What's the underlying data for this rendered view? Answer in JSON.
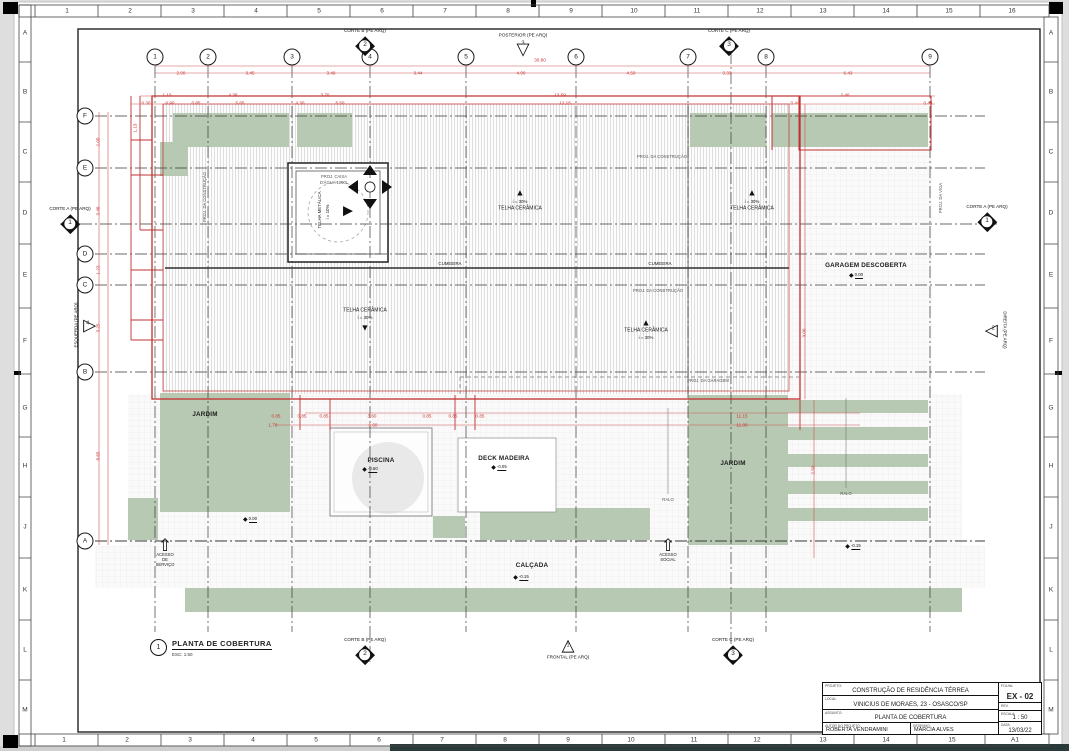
{
  "frame": {
    "top_cells": [
      {
        "t": "1",
        "x": 67
      },
      {
        "t": "2",
        "x": 130
      },
      {
        "t": "3",
        "x": 193
      },
      {
        "t": "4",
        "x": 256
      },
      {
        "t": "5",
        "x": 319
      },
      {
        "t": "6",
        "x": 382
      },
      {
        "t": "7",
        "x": 445
      },
      {
        "t": "8",
        "x": 508
      },
      {
        "t": "9",
        "x": 571
      },
      {
        "t": "10",
        "x": 634
      },
      {
        "t": "11",
        "x": 697
      },
      {
        "t": "12",
        "x": 760
      },
      {
        "t": "13",
        "x": 823
      },
      {
        "t": "14",
        "x": 886
      },
      {
        "t": "15",
        "x": 949
      },
      {
        "t": "16",
        "x": 1012
      }
    ],
    "bottom_cells": [
      {
        "t": "1",
        "x": 64
      },
      {
        "t": "2",
        "x": 127
      },
      {
        "t": "3",
        "x": 190
      },
      {
        "t": "4",
        "x": 253
      },
      {
        "t": "5",
        "x": 316
      },
      {
        "t": "6",
        "x": 379
      },
      {
        "t": "7",
        "x": 442
      },
      {
        "t": "8",
        "x": 505
      },
      {
        "t": "9",
        "x": 568
      },
      {
        "t": "10",
        "x": 631
      },
      {
        "t": "11",
        "x": 694
      },
      {
        "t": "12",
        "x": 757
      },
      {
        "t": "13",
        "x": 823
      },
      {
        "t": "14",
        "x": 886
      },
      {
        "t": "15",
        "x": 952
      },
      {
        "t": "A1",
        "x": 1015
      }
    ],
    "left_cells": [
      {
        "t": "A",
        "y": 33
      },
      {
        "t": "B",
        "y": 92
      },
      {
        "t": "C",
        "y": 152
      },
      {
        "t": "D",
        "y": 213
      },
      {
        "t": "E",
        "y": 275
      },
      {
        "t": "F",
        "y": 341
      },
      {
        "t": "G",
        "y": 408
      },
      {
        "t": "H",
        "y": 466
      },
      {
        "t": "J",
        "y": 527
      },
      {
        "t": "K",
        "y": 590
      },
      {
        "t": "L",
        "y": 650
      },
      {
        "t": "M",
        "y": 710
      }
    ],
    "right_cells": [
      {
        "t": "A",
        "y": 33
      },
      {
        "t": "B",
        "y": 92
      },
      {
        "t": "C",
        "y": 152
      },
      {
        "t": "D",
        "y": 213
      },
      {
        "t": "E",
        "y": 275
      },
      {
        "t": "F",
        "y": 341
      },
      {
        "t": "G",
        "y": 408
      },
      {
        "t": "H",
        "y": 466
      },
      {
        "t": "J",
        "y": 527
      },
      {
        "t": "K",
        "y": 590
      },
      {
        "t": "L",
        "y": 650
      },
      {
        "t": "M",
        "y": 710
      }
    ]
  },
  "axes": {
    "cols": [
      {
        "n": "1",
        "x": 155
      },
      {
        "n": "2",
        "x": 208
      },
      {
        "n": "3",
        "x": 292
      },
      {
        "n": "4",
        "x": 370
      },
      {
        "n": "5",
        "x": 466
      },
      {
        "n": "6",
        "x": 576
      },
      {
        "n": "7",
        "x": 688
      },
      {
        "n": "8",
        "x": 766
      },
      {
        "n": "9",
        "x": 930
      }
    ],
    "rows": [
      {
        "n": "F",
        "y": 116
      },
      {
        "n": "E",
        "y": 168
      },
      {
        "n": "D",
        "y": 254
      },
      {
        "n": "C",
        "y": 285
      },
      {
        "n": "B",
        "y": 372
      },
      {
        "n": "A",
        "y": 541
      }
    ]
  },
  "markers": [
    {
      "label": "CORTE B (PE ARQ)",
      "num": "2",
      "x": 365,
      "y": 43,
      "cls": "diamond"
    },
    {
      "label": "POSTERIOR (PE ARQ)",
      "num": "3",
      "x": 523,
      "y": 46,
      "cls": "tri-down"
    },
    {
      "label": "CORTE C (PE ARQ)",
      "num": "3",
      "x": 729,
      "y": 43,
      "cls": "diamond"
    },
    {
      "label": "CORTE A (PE ARQ)",
      "num": "1",
      "x": 70,
      "y": 221,
      "cls": "diamond"
    },
    {
      "label": "ESQUERDA (PE ARQ)",
      "num": "4",
      "x": 87,
      "y": 325,
      "cls": "tri-right lvert"
    },
    {
      "label": "CORTE A (PE ARQ)",
      "num": "1",
      "x": 987,
      "y": 219,
      "cls": "diamond"
    },
    {
      "label": "DIREITA (PE ARQ)",
      "num": "2",
      "x": 994,
      "y": 330,
      "cls": "tri-left lvert-r"
    },
    {
      "label": "CORTE B (PE ARQ)",
      "num": "2",
      "x": 365,
      "y": 652,
      "cls": "diamond"
    },
    {
      "label": "FRONTAL (PE ARQ)",
      "num": "1",
      "x": 568,
      "y": 648,
      "cls": "tri-up lbottom"
    },
    {
      "label": "CORTE C (PE ARQ)",
      "num": "3",
      "x": 733,
      "y": 652,
      "cls": "diamond"
    }
  ],
  "labels": [
    {
      "t": "JARDIM",
      "x": 205,
      "y": 415,
      "cls": "bold"
    },
    {
      "t": "JARDIM",
      "x": 733,
      "y": 464,
      "cls": "bold"
    },
    {
      "t": "PISCINA",
      "x": 381,
      "y": 461,
      "cls": "bold"
    },
    {
      "t": "DECK MADEIRA",
      "x": 504,
      "y": 459,
      "cls": "bold"
    },
    {
      "t": "GARAGEM DESCOBERTA",
      "x": 866,
      "y": 266,
      "cls": "bold"
    },
    {
      "t": "CALÇADA",
      "x": 532,
      "y": 566,
      "cls": "bold"
    },
    {
      "t": "CUMEEIRA",
      "x": 450,
      "y": 264,
      "cls": "small"
    },
    {
      "t": "CUMEEIRA",
      "x": 660,
      "y": 264,
      "cls": "small"
    },
    {
      "t": "i = 30%",
      "x": 520,
      "y": 202,
      "cls": "small"
    },
    {
      "t": "TELHA CERÂMICA",
      "x": 520,
      "y": 209
    },
    {
      "t": "i = 30%",
      "x": 752,
      "y": 202,
      "cls": "small"
    },
    {
      "t": "TELHA CERÂMICA",
      "x": 752,
      "y": 209
    },
    {
      "t": "TELHA CERÂMICA",
      "x": 365,
      "y": 311
    },
    {
      "t": "i = 30%",
      "x": 365,
      "y": 318,
      "cls": "small"
    },
    {
      "t": "TELHA CERÂMICA",
      "x": 646,
      "y": 331
    },
    {
      "t": "i = 30%",
      "x": 646,
      "y": 338,
      "cls": "small"
    },
    {
      "t": "TELHA METÁLICA",
      "x": 320,
      "y": 210,
      "cls": "vert small"
    },
    {
      "t": "i = 10%",
      "x": 328,
      "y": 212,
      "cls": "vert small"
    },
    {
      "t": "PROJ. CAIXA",
      "x": 334,
      "y": 177,
      "cls": "tiny"
    },
    {
      "t": "D'ÁGUA 1000L",
      "x": 334,
      "y": 183,
      "cls": "tiny"
    },
    {
      "t": "PROJ. DA CONSTRUÇÃO",
      "x": 662,
      "y": 157,
      "cls": "tiny"
    },
    {
      "t": "PROJ. DA CONSTRUÇÃO",
      "x": 658,
      "y": 291,
      "cls": "tiny"
    },
    {
      "t": "PROJ. DA GARAGEM",
      "x": 708,
      "y": 381,
      "cls": "tiny"
    },
    {
      "t": "PROJ. DA CONSTRUÇÃO",
      "x": 205,
      "y": 197,
      "cls": "tiny vert"
    },
    {
      "t": "PROJ. DA VIGA",
      "x": 941,
      "y": 198,
      "cls": "tiny vert"
    },
    {
      "t": "RALO",
      "x": 668,
      "y": 500,
      "cls": "tiny"
    },
    {
      "t": "RALO",
      "x": 846,
      "y": 494,
      "cls": "tiny"
    }
  ],
  "roof_arrows": [
    {
      "g": "▲",
      "x": 520,
      "y": 193
    },
    {
      "g": "▲",
      "x": 752,
      "y": 193
    },
    {
      "g": "▼",
      "x": 365,
      "y": 328
    },
    {
      "g": "▲",
      "x": 646,
      "y": 323
    },
    {
      "g": "▶",
      "x": 348,
      "y": 210,
      "cls": "big"
    }
  ],
  "dims": [
    {
      "t": "30.80",
      "x": 540,
      "y": 61
    },
    {
      "t": "2.00",
      "x": 181,
      "y": 74
    },
    {
      "t": "3.45",
      "x": 250,
      "y": 74
    },
    {
      "t": "3.49",
      "x": 331,
      "y": 74
    },
    {
      "t": "3.44",
      "x": 418,
      "y": 74
    },
    {
      "t": "4.00",
      "x": 521,
      "y": 74
    },
    {
      "t": "4.50",
      "x": 631,
      "y": 74
    },
    {
      "t": "3.33",
      "x": 727,
      "y": 74
    },
    {
      "t": "6.43",
      "x": 848,
      "y": 74
    },
    {
      "t": "1.10",
      "x": 167,
      "y": 96
    },
    {
      "t": "4.38",
      "x": 233,
      "y": 96
    },
    {
      "t": "3.70",
      "x": 325,
      "y": 96
    },
    {
      "t": "13.59",
      "x": 560,
      "y": 96
    },
    {
      "t": "2.40",
      "x": 845,
      "y": 96
    },
    {
      "t": "0.30",
      "x": 146,
      "y": 104
    },
    {
      "t": "0.90",
      "x": 170,
      "y": 104
    },
    {
      "t": "0.85",
      "x": 196,
      "y": 104
    },
    {
      "t": "5.65",
      "x": 240,
      "y": 104
    },
    {
      "t": "4.30",
      "x": 300,
      "y": 104
    },
    {
      "t": "5.50",
      "x": 340,
      "y": 104
    },
    {
      "t": "12.15",
      "x": 565,
      "y": 104
    },
    {
      "t": "0.44",
      "x": 795,
      "y": 104
    },
    {
      "t": "0.44",
      "x": 928,
      "y": 104
    },
    {
      "t": "2.05",
      "x": 99,
      "y": 142,
      "cls": "rot"
    },
    {
      "t": "3.48",
      "x": 99,
      "y": 211,
      "cls": "rot"
    },
    {
      "t": "1.23",
      "x": 99,
      "y": 270,
      "cls": "rot"
    },
    {
      "t": "3.25",
      "x": 99,
      "y": 328,
      "cls": "rot"
    },
    {
      "t": "8.65",
      "x": 99,
      "y": 456,
      "cls": "rot"
    },
    {
      "t": "1.13",
      "x": 136,
      "y": 128,
      "cls": "rot"
    },
    {
      "t": "0.85",
      "x": 276,
      "y": 417
    },
    {
      "t": "0.85",
      "x": 302,
      "y": 417
    },
    {
      "t": "0.85",
      "x": 324,
      "y": 417
    },
    {
      "t": "3.60",
      "x": 372,
      "y": 417
    },
    {
      "t": "0.85",
      "x": 427,
      "y": 417
    },
    {
      "t": "0.85",
      "x": 453,
      "y": 417
    },
    {
      "t": "0.85",
      "x": 480,
      "y": 417
    },
    {
      "t": "1.70",
      "x": 273,
      "y": 426
    },
    {
      "t": "8.60",
      "x": 373,
      "y": 426
    },
    {
      "t": "11.15",
      "x": 742,
      "y": 417
    },
    {
      "t": "11.00",
      "x": 742,
      "y": 426
    },
    {
      "t": "3.00",
      "x": 805,
      "y": 333,
      "cls": "rot"
    },
    {
      "t": "2.50",
      "x": 814,
      "y": 470,
      "cls": "rot"
    }
  ],
  "levels": [
    {
      "v": "0.00",
      "x": 856,
      "y": 276
    },
    {
      "v": "-0.60",
      "x": 370,
      "y": 470
    },
    {
      "v": "-0.05",
      "x": 499,
      "y": 468
    },
    {
      "v": "-0.15",
      "x": 521,
      "y": 578
    },
    {
      "v": "-0.15",
      "x": 853,
      "y": 547
    },
    {
      "v": "0.00",
      "x": 250,
      "y": 520
    }
  ],
  "access_arrows": [
    {
      "label": "ACESSO\nDE\nSERVIÇO",
      "x": 165,
      "y": 538
    },
    {
      "label": "ACESSO\nSOCIAL",
      "x": 668,
      "y": 538
    }
  ],
  "drawing_title": {
    "num": "1",
    "title": "PLANTA DE COBERTURA",
    "scale": "ESC: 1:50"
  },
  "titleblock": {
    "projeto_label": "PROJETO:",
    "projeto": "CONSTRUÇÃO DE RESIDÊNCIA TÉRREA",
    "local_label": "LOCAL:",
    "local": "VINICIUS DE MORAES, 23 - OSASCO/SP",
    "assunto_label": "ASSUNTO:",
    "assunto": "PLANTA DE COBERTURA",
    "autor_label": "AUTOR DO PROJETO:",
    "autor": "ROBERTA VENDRAMINI",
    "desenho_label": "DESENHO:",
    "desenho": "MARCIA ALVES",
    "folha_label": "FOLHA:",
    "folha": "EX - 02",
    "rev_label": "REV.",
    "escala_label": "ESCALA:",
    "escala": "1 : 50",
    "data_label": "DATA:",
    "data": "13/03/22"
  },
  "colors": {
    "garden_green": "#b7c9b2",
    "dimension_red": "#cc3333",
    "paper": "#ffffff",
    "dark_strip": "#2a3a3a"
  }
}
